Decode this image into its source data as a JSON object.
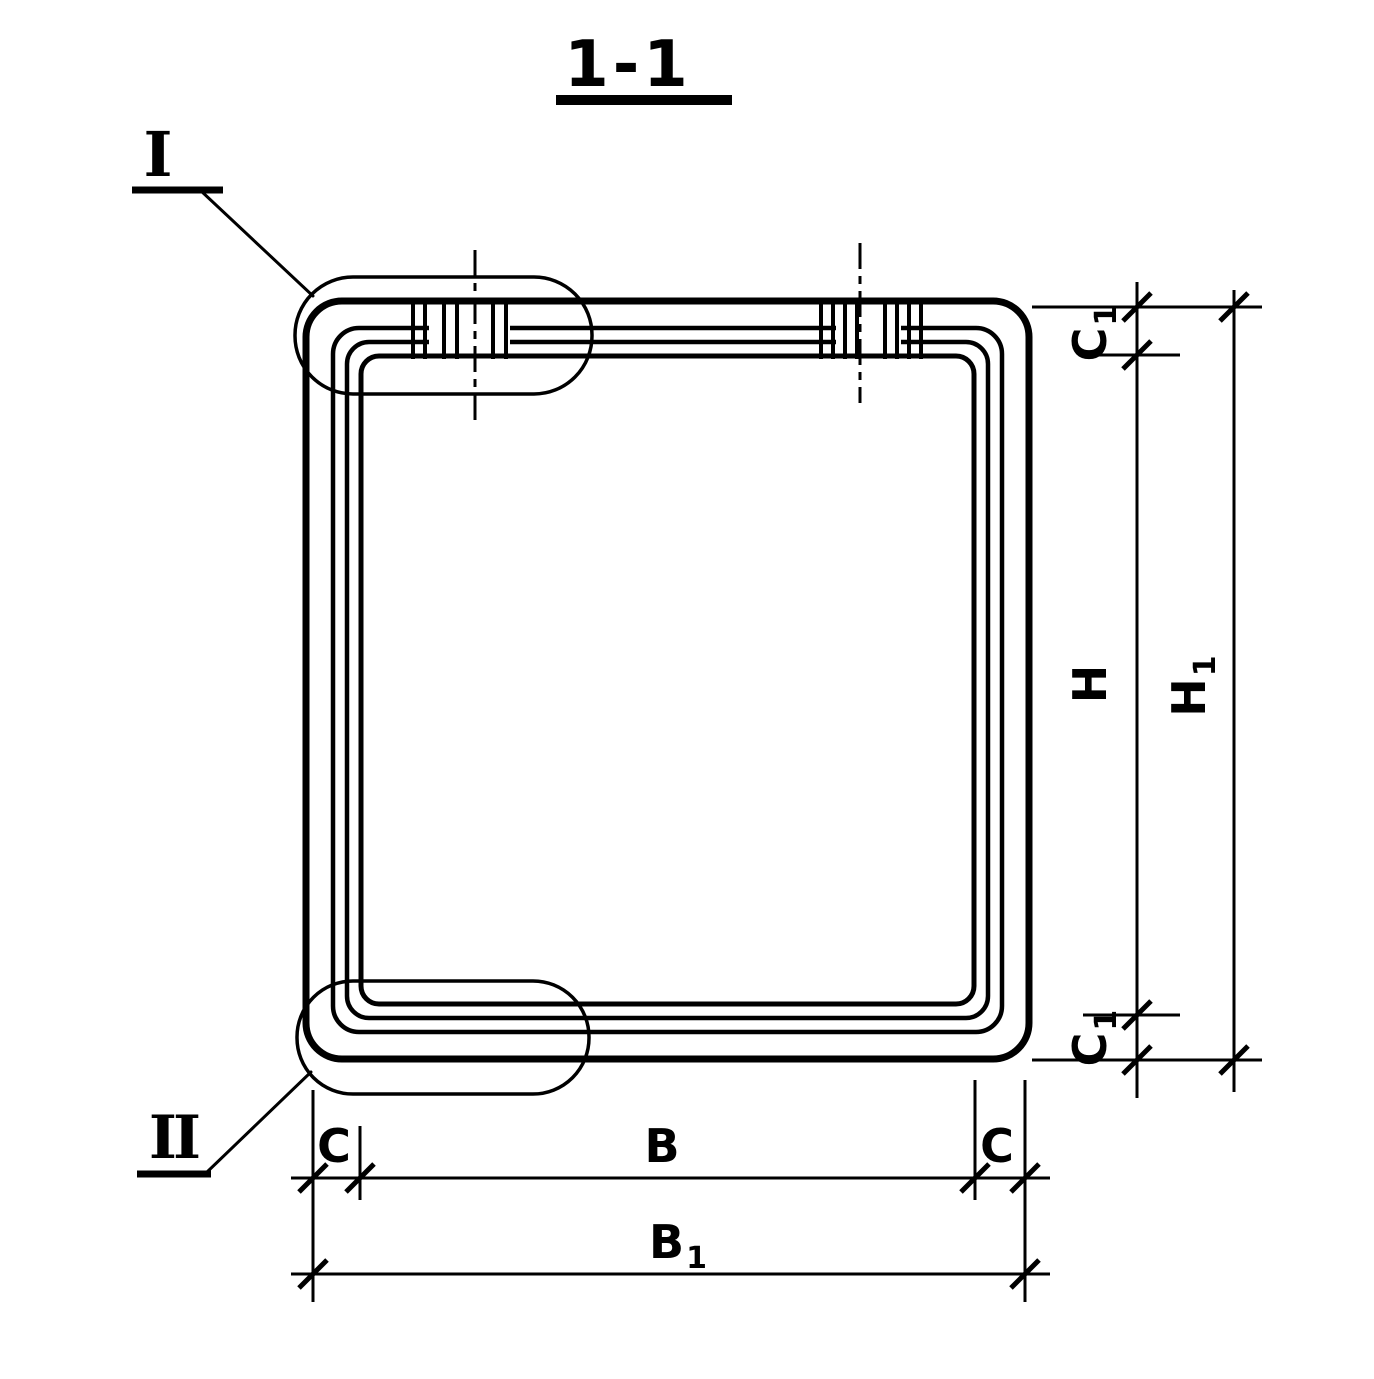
{
  "colors": {
    "ink": "#000000",
    "paper": "#ffffff"
  },
  "drawing": {
    "section_title": "1-1",
    "callouts": {
      "detail_top_left": "I",
      "detail_bottom_left": "II"
    },
    "dimensions": {
      "c1_top": {
        "base": "C",
        "sub": "1"
      },
      "h": "H",
      "h1": {
        "base": "H",
        "sub": "1"
      },
      "c1_bottom": {
        "base": "C",
        "sub": "1"
      },
      "c_left": "C",
      "b": "B",
      "c_right": "C",
      "b1": {
        "base": "B",
        "sub": "1"
      }
    }
  }
}
